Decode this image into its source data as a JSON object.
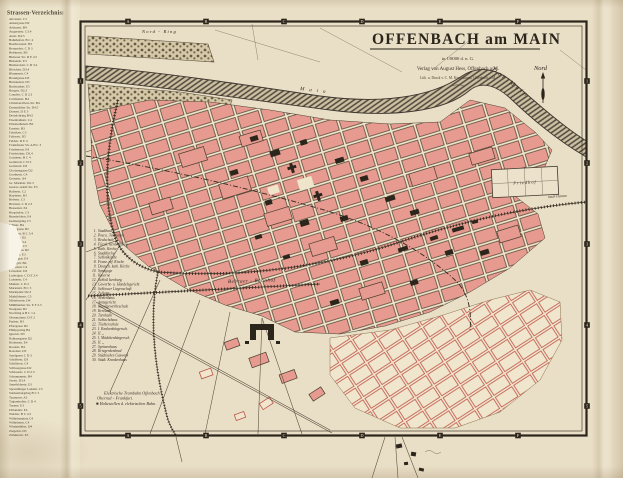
{
  "title_block": {
    "title": "OFFENBACH am MAIN",
    "scale_line": "in 1/8000 d. n. G.",
    "publisher": "Verlag von August Hess, Offenbach a/M.",
    "printer": "Lith. u. Druck v. C. M. Kirschbaum, Offenbach a/M."
  },
  "compass": {
    "label": "Nord"
  },
  "grid": {
    "cols": [
      "A",
      "B",
      "C",
      "D",
      "E",
      "F"
    ],
    "rows": [
      "1",
      "2",
      "3",
      "4",
      "5"
    ]
  },
  "labels": {
    "nord_ring": "Nord - Ring",
    "river": "Der Main",
    "river2": "Main",
    "bebraer": "Bebraer - Bahnhof",
    "friedhof": "Friedhof",
    "nach_hanau": "nach Hanau"
  },
  "street_index": {
    "heading": "Strassen-Verzeichnis:",
    "entries": [
      "Alicenstr. C3",
      "Ankergasse D2",
      "Arthurstr. B4",
      "Augustastr. C3.4",
      "Austr. D4.5",
      "Bahnhofstr. B C 4",
      "Beethovenstr. B3",
      "Bernardstr. C D 3",
      "Bettinastr. B3",
      "Bieberer Str. D E 4.5",
      "Birkenstr. E3",
      "Bismarckstr. C D 3.4",
      "Bleichstr. D3.4",
      "Blumenstr. C4",
      "Brandgasse D3",
      "Brunnenstr. D3",
      "Buchrainstr. E5",
      "Burgstr. D2.3",
      "Canalstr. C D 2.3",
      "Cäcilienstr. B4",
      "Christian-Pless-Str. B4",
      "Darmstädter Str. D4.5",
      "Domstr. D E 3",
      "Dreieichring B4.5",
      "Eisenbahnstr. C4",
      "Elisabethenstr. B3",
      "Ernststr. B3",
      "Fabrikstr. C3",
      "Falterstr. D5",
      "Feldstr. D E 4",
      "Frankfurter Str. A B C 3",
      "Friedensstr. E4",
      "Friedrichstr. D3.4",
      "Gartenstr. B C 4",
      "Geleitsstr. C D 3",
      "Gerberstr. D3",
      "Glockengasse D2",
      "Goethestr. C4",
      "Grenzstr. A4",
      "Gr. Marktstr. D2.3",
      "Gustav-Adolf-Str. E3",
      "Hafenstr. C2",
      "Haydnstr. B3",
      "Hebestr. C3",
      "Herrnstr. C D 2.3",
      "Hessenstr. E4",
      "Hospitalstr. C3",
      "Humboldtstr. E4",
      "Isenburgring C5",
      "Jahnstr. B4",
      "Justizgasse D2",
      "Kaiserstr. B C 3.4",
      "Kanalstr. D2",
      "Karlstr. C3.4",
      "Kettenstr. C3",
      "Kirchgasse D2",
      "Krafftstr. E3",
      "Lessingstr. E4",
      "Liebigstr. B4",
      "Lindenstr. C4",
      "Löwenstr. D3",
      "Ludwigstr. C D E 3.4",
      "Luisenstr. C4",
      "Mainstr. C D 2",
      "Marienstr. B C 3",
      "Marktplatz D2.3",
      "Mathildenstr. C3",
      "Mittelseestr. D4",
      "Mühlheimer Str. E F 2.3",
      "Neugasse D2",
      "Nordring A B C 1.2",
      "Obermainstr. D E 2",
      "Parkstr. B3",
      "Pfarrgasse D2",
      "Philippsring B4",
      "Querstr. D3",
      "Rathausgasse D2",
      "Rödernstr. E4",
      "Roonstr. B4",
      "Rosenstr. D3",
      "Sandgasse C D 3",
      "Schäferstr. D3",
      "Schillerstr. C4",
      "Schlossgasse D2",
      "Schlossstr. C D 2.3",
      "Schumannstr. B4",
      "Seestr. D3.4",
      "Senefelderstr. E3",
      "Sprendlinger Landstr. C5",
      "Starkenburgring B C 5",
      "Taunusstr. A3",
      "Tulpenhofstr. C D 4",
      "Turnstr. E3",
      "Uhlandstr. E4",
      "Waldstr. B C 4.5",
      "Wilhelmsplatz C4",
      "Wilhelmstr. C4",
      "Windmühlstr. D4",
      "Ziegelstr. D3",
      "Zimmerstr. E3"
    ]
  },
  "legend": {
    "items": [
      {
        "n": "1.",
        "label": "Stadthaus"
      },
      {
        "n": "2.",
        "label": "Post u. Telegraph"
      },
      {
        "n": "3.",
        "label": "Realschule"
      },
      {
        "n": "4.",
        "label": "Fürstl. Isenb. Palais"
      },
      {
        "n": "5.",
        "label": "Kath. Kirche"
      },
      {
        "n": "6.",
        "label": "Stadtkirche"
      },
      {
        "n": "7.",
        "label": "Schloßkirche"
      },
      {
        "n": "8.",
        "label": "Franz. ref. Kirche"
      },
      {
        "n": "9.",
        "label": "Deutsch. kath. Kirche"
      },
      {
        "n": "10.",
        "label": "Synagoge"
      },
      {
        "n": "11.",
        "label": "Kaserne"
      },
      {
        "n": "12.",
        "label": "Schloß Isenburg"
      },
      {
        "n": "13.",
        "label": "Gewerbe- u. Handelsgericht"
      },
      {
        "n": "14.",
        "label": "Schlosser Liegenschaft"
      },
      {
        "n": "15.",
        "label": "Zollamt"
      },
      {
        "n": "16.",
        "label": "Armenhaus"
      },
      {
        "n": "17.",
        "label": "Amtsgericht"
      },
      {
        "n": "18.",
        "label": "Kunstgewerbeschule"
      },
      {
        "n": "19.",
        "label": "Kreisamt"
      },
      {
        "n": "20.",
        "label": "Turnhalle"
      },
      {
        "n": "21.",
        "label": "Schlachthaus"
      },
      {
        "n": "22.",
        "label": "Töchterschule"
      },
      {
        "n": "23.",
        "label": "I. Knabenbürgersch."
      },
      {
        "n": "24.",
        "label": "II.      „"
      },
      {
        "n": "25.",
        "label": "I. Mädchenbürgersch."
      },
      {
        "n": "26.",
        "label": "II.      „"
      },
      {
        "n": "27.",
        "label": "Spritzenhaus"
      },
      {
        "n": "28.",
        "label": "Kriegerdenkmal"
      },
      {
        "n": "29.",
        "label": "Städtisches Gaswerk"
      },
      {
        "n": "30.",
        "label": "Städt. Krankenhaus"
      }
    ]
  },
  "tram_note": {
    "lines": [
      "Elektrische Trambahn Offenbach –",
      "Oberrad – Frankfurt.",
      "■ Haltestellen d. elektrischen Bahn."
    ]
  },
  "colors": {
    "paper": "#e9dec6",
    "pink": "#e79a8f",
    "red": "#c0544a",
    "ink": "#352d22",
    "river": "#4e463c"
  }
}
